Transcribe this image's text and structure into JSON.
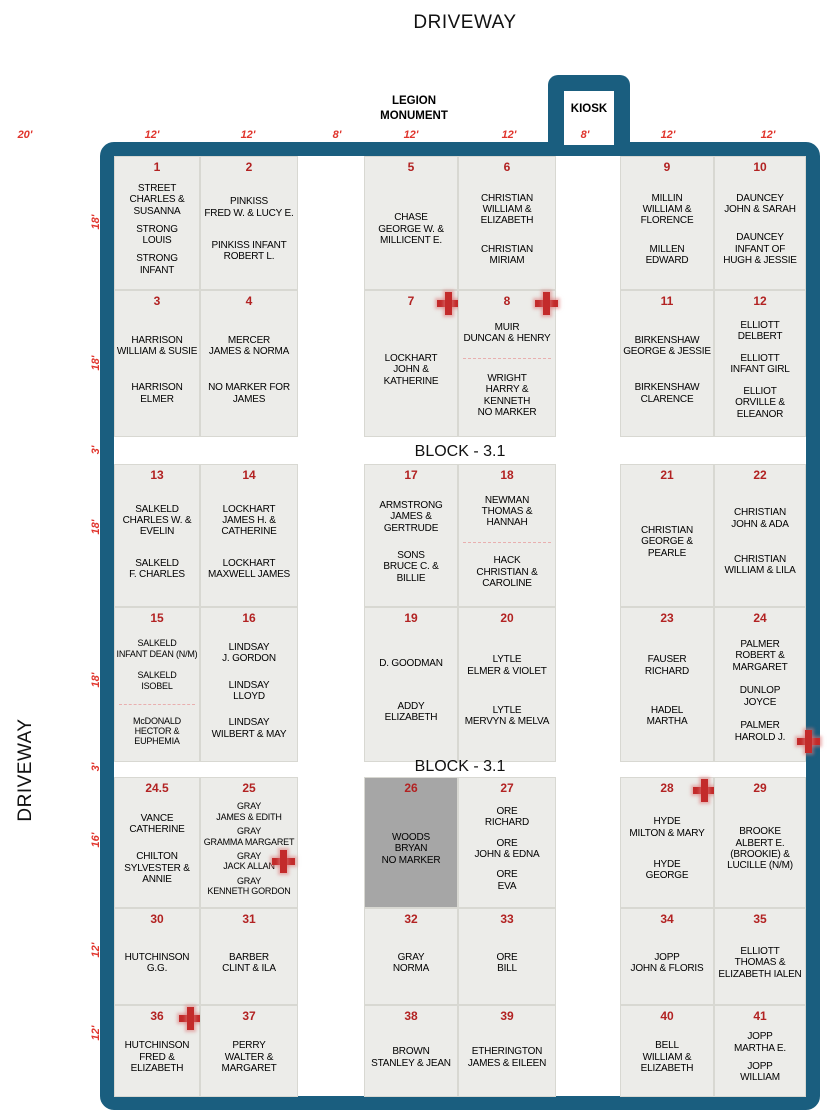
{
  "page": {
    "driveway_top": "DRIVEWAY",
    "driveway_left": "DRIVEWAY",
    "legion_monument": "LEGION\nMONUMENT",
    "kiosk": "KIOSK",
    "block_label_1": "BLOCK - 3.1",
    "block_label_2": "BLOCK - 3.1"
  },
  "colors": {
    "border": "#1A5E7F",
    "plot_background": "#ECECE9",
    "shaded_plot_background": "#A6A6A6",
    "plot_number": "#B22222",
    "dimension_label": "#E0342C",
    "grave_marker": "#C32B2B"
  },
  "dimensions_top": [
    {
      "label": "20'",
      "x": 25
    },
    {
      "label": "12'",
      "x": 152
    },
    {
      "label": "12'",
      "x": 248
    },
    {
      "label": "8'",
      "x": 337
    },
    {
      "label": "12'",
      "x": 411
    },
    {
      "label": "12'",
      "x": 509
    },
    {
      "label": "8'",
      "x": 585
    },
    {
      "label": "12'",
      "x": 668
    },
    {
      "label": "12'",
      "x": 768
    }
  ],
  "dimensions_left": [
    {
      "label": "18'",
      "y": 222
    },
    {
      "label": "18'",
      "y": 363
    },
    {
      "label": "3'",
      "y": 450
    },
    {
      "label": "18'",
      "y": 527
    },
    {
      "label": "18'",
      "y": 680
    },
    {
      "label": "3'",
      "y": 767
    },
    {
      "label": "16'",
      "y": 840
    },
    {
      "label": "12'",
      "y": 950
    },
    {
      "label": "12'",
      "y": 1033
    }
  ],
  "plots": [
    {
      "num": "1",
      "col": 0,
      "row": 0,
      "sections": [
        [
          "STREET\nCHARLES &\nSUSANNA",
          "STRONG\nLOUIS",
          "STRONG\nINFANT"
        ]
      ]
    },
    {
      "num": "2",
      "col": 1,
      "row": 0,
      "sections": [
        [
          "PINKISS\nFRED W. & LUCY E.",
          "PINKISS INFANT\nROBERT L."
        ]
      ]
    },
    {
      "num": "5",
      "col": 2,
      "row": 0,
      "sections": [
        [
          "CHASE\nGEORGE W. &\nMILLICENT E."
        ]
      ]
    },
    {
      "num": "6",
      "col": 3,
      "row": 0,
      "sections": [
        [
          "CHRISTIAN\nWILLIAM &\nELIZABETH",
          "CHRISTIAN\nMIRIAM"
        ]
      ]
    },
    {
      "num": "9",
      "col": 4,
      "row": 0,
      "sections": [
        [
          "MILLIN\nWILLIAM &\nFLORENCE",
          "MILLEN\nEDWARD"
        ]
      ]
    },
    {
      "num": "10",
      "col": 5,
      "row": 0,
      "sections": [
        [
          "DAUNCEY\nJOHN & SARAH",
          "DAUNCEY\nINFANT OF\nHUGH & JESSIE"
        ]
      ]
    },
    {
      "num": "3",
      "col": 0,
      "row": 1,
      "sections": [
        [
          "HARRISON\nWILLIAM & SUSIE",
          "HARRISON\nELMER"
        ]
      ]
    },
    {
      "num": "4",
      "col": 1,
      "row": 1,
      "sections": [
        [
          "MERCER\nJAMES & NORMA",
          "NO MARKER FOR\nJAMES"
        ]
      ]
    },
    {
      "num": "7",
      "col": 2,
      "row": 1,
      "marker": "top-right",
      "sections": [
        [
          "LOCKHART\nJOHN &\nKATHERINE"
        ]
      ]
    },
    {
      "num": "8",
      "col": 3,
      "row": 1,
      "marker": "top-right",
      "sections": [
        [
          "MUIR\nDUNCAN & HENRY"
        ],
        [
          "WRIGHT\nHARRY &\nKENNETH\nNO MARKER"
        ]
      ]
    },
    {
      "num": "11",
      "col": 4,
      "row": 1,
      "sections": [
        [
          "BIRKENSHAW\nGEORGE & JESSIE",
          "BIRKENSHAW\nCLARENCE"
        ]
      ]
    },
    {
      "num": "12",
      "col": 5,
      "row": 1,
      "sections": [
        [
          "ELLIOTT\nDELBERT",
          "ELLIOTT\nINFANT GIRL",
          "ELLIOT\nORVILLE &\nELEANOR"
        ]
      ]
    },
    {
      "num": "13",
      "col": 0,
      "row": 2,
      "sections": [
        [
          "SALKELD\nCHARLES W. &\nEVELIN",
          "SALKELD\nF. CHARLES"
        ]
      ]
    },
    {
      "num": "14",
      "col": 1,
      "row": 2,
      "sections": [
        [
          "LOCKHART\nJAMES H. &\nCATHERINE",
          "LOCKHART\nMAXWELL JAMES"
        ]
      ]
    },
    {
      "num": "17",
      "col": 2,
      "row": 2,
      "sections": [
        [
          "ARMSTRONG\nJAMES &\nGERTRUDE",
          "SONS\nBRUCE C. &\nBILLIE"
        ]
      ]
    },
    {
      "num": "18",
      "col": 3,
      "row": 2,
      "sections": [
        [
          "NEWMAN\nTHOMAS &\nHANNAH"
        ],
        [
          "HACK\nCHRISTIAN &\nCAROLINE"
        ]
      ]
    },
    {
      "num": "21",
      "col": 4,
      "row": 2,
      "sections": [
        [
          "CHRISTIAN\nGEORGE &\nPEARLE"
        ]
      ]
    },
    {
      "num": "22",
      "col": 5,
      "row": 2,
      "sections": [
        [
          "CHRISTIAN\nJOHN & ADA",
          "CHRISTIAN\nWILLIAM & LILA"
        ]
      ]
    },
    {
      "num": "15",
      "col": 0,
      "row": 3,
      "small": true,
      "sections": [
        [
          "SALKELD\nINFANT DEAN (N/M)",
          "SALKELD\nISOBEL"
        ],
        [
          "McDONALD\nHECTOR &\nEUPHEMIA"
        ]
      ]
    },
    {
      "num": "16",
      "col": 1,
      "row": 3,
      "sections": [
        [
          "LINDSAY\nJ. GORDON",
          "LINDSAY\nLLOYD",
          "LINDSAY\nWILBERT & MAY"
        ]
      ]
    },
    {
      "num": "19",
      "col": 2,
      "row": 3,
      "sections": [
        [
          "D. GOODMAN",
          "ADDY\nELIZABETH"
        ]
      ]
    },
    {
      "num": "20",
      "col": 3,
      "row": 3,
      "sections": [
        [
          "LYTLE\nELMER & VIOLET",
          "LYTLE\nMERVYN & MELVA"
        ]
      ]
    },
    {
      "num": "23",
      "col": 4,
      "row": 3,
      "sections": [
        [
          "FAUSER\nRICHARD",
          "HADEL\nMARTHA"
        ]
      ]
    },
    {
      "num": "24",
      "col": 5,
      "row": 3,
      "marker": "bottom-right",
      "sections": [
        [
          "PALMER\nROBERT &\nMARGARET",
          "DUNLOP\nJOYCE",
          "PALMER\nHAROLD J."
        ]
      ]
    },
    {
      "num": "24.5",
      "col": 0,
      "row": 4,
      "sections": [
        [
          "VANCE\nCATHERINE",
          "CHILTON\nSYLVESTER &\nANNIE"
        ]
      ]
    },
    {
      "num": "25",
      "col": 1,
      "row": 4,
      "small": true,
      "marker": "mid-right",
      "sections": [
        [
          "GRAY\nJAMES & EDITH",
          "GRAY\nGRAMMA MARGARET",
          "GRAY\nJACK ALLAN",
          "GRAY\nKENNETH GORDON"
        ]
      ]
    },
    {
      "num": "26",
      "col": 2,
      "row": 4,
      "shaded": true,
      "sections": [
        [
          "WOODS\nBRYAN\nNO MARKER"
        ]
      ]
    },
    {
      "num": "27",
      "col": 3,
      "row": 4,
      "sections": [
        [
          "ORE\nRICHARD",
          "ORE\nJOHN & EDNA",
          "ORE\nEVA"
        ]
      ]
    },
    {
      "num": "28",
      "col": 4,
      "row": 4,
      "marker": "top-right",
      "sections": [
        [
          "HYDE\nMILTON & MARY",
          "HYDE\nGEORGE"
        ]
      ]
    },
    {
      "num": "29",
      "col": 5,
      "row": 4,
      "sections": [
        [
          "BROOKE\nALBERT E.\n(BROOKIE) &\nLUCILLE (N/M)"
        ]
      ]
    },
    {
      "num": "30",
      "col": 0,
      "row": 5,
      "sections": [
        [
          "HUTCHINSON\nG.G."
        ]
      ]
    },
    {
      "num": "31",
      "col": 1,
      "row": 5,
      "sections": [
        [
          "BARBER\nCLINT & ILA"
        ]
      ]
    },
    {
      "num": "32",
      "col": 2,
      "row": 5,
      "sections": [
        [
          "GRAY\nNORMA"
        ]
      ]
    },
    {
      "num": "33",
      "col": 3,
      "row": 5,
      "sections": [
        [
          "ORE\nBILL"
        ]
      ]
    },
    {
      "num": "34",
      "col": 4,
      "row": 5,
      "sections": [
        [
          "JOPP\nJOHN & FLORIS"
        ]
      ]
    },
    {
      "num": "35",
      "col": 5,
      "row": 5,
      "sections": [
        [
          "ELLIOTT\nTHOMAS &\nELIZABETH IALEN"
        ]
      ]
    },
    {
      "num": "36",
      "col": 0,
      "row": 6,
      "marker": "top-right",
      "sections": [
        [
          "HUTCHINSON\nFRED &\nELIZABETH"
        ]
      ]
    },
    {
      "num": "37",
      "col": 1,
      "row": 6,
      "sections": [
        [
          "PERRY\nWALTER &\nMARGARET"
        ]
      ]
    },
    {
      "num": "38",
      "col": 2,
      "row": 6,
      "sections": [
        [
          "BROWN\nSTANLEY & JEAN"
        ]
      ]
    },
    {
      "num": "39",
      "col": 3,
      "row": 6,
      "sections": [
        [
          "ETHERINGTON\nJAMES & EILEEN"
        ]
      ]
    },
    {
      "num": "40",
      "col": 4,
      "row": 6,
      "sections": [
        [
          "BELL\nWILLIAM &\nELIZABETH"
        ]
      ]
    },
    {
      "num": "41",
      "col": 5,
      "row": 6,
      "sections": [
        [
          "JOPP\nMARTHA E.",
          "JOPP\nWILLIAM"
        ]
      ]
    }
  ]
}
